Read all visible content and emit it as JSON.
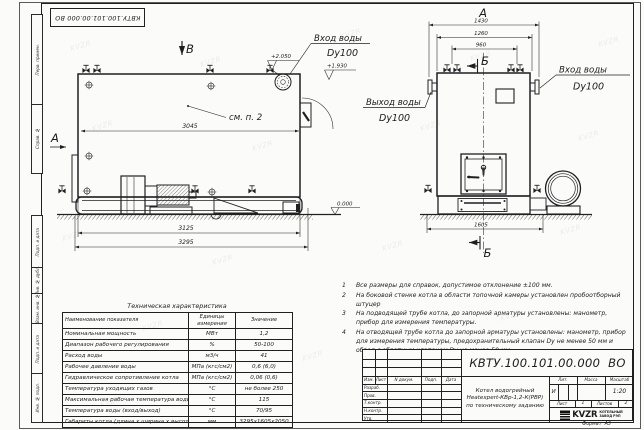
{
  "stamp_top": "КВТУ.100.101.00.000 ВО",
  "watermark": "KVZR",
  "frame_labels": {
    "top": [
      "Перв. примен.",
      "Справ. №"
    ],
    "bottom": [
      "Подп. и дата",
      "Инв. № дубл.",
      "Взам. инв. №",
      "Подп. и дата",
      "Инв. № подл."
    ]
  },
  "side_view": {
    "section_mark_top": "В",
    "view_arrow_left": "А",
    "note_ref": "см. п. 2",
    "dim_body": "3045",
    "dim_frame": "3125",
    "dim_overall": "3295",
    "level_inlet": "+2.050",
    "level_hatch": "+1.930",
    "inlet_line1": "Вход воды",
    "inlet_line2": "Dy100"
  },
  "front_view": {
    "view_label": "А",
    "section_label_top": "Б",
    "section_label_bottom": "Б",
    "dim_overall": "1430",
    "dim_flanges": "1260",
    "dim_valves": "960",
    "dim_base": "1605",
    "outlet_line1": "Выход воды",
    "outlet_line2": "Dy100",
    "inlet_line1": "Вход воды",
    "inlet_line2": "Dy100"
  },
  "ground_level": "0.000",
  "notes": [
    {
      "num": "1",
      "text": "Все размеры для справок, допустимое отклонение ±100 мм."
    },
    {
      "num": "2",
      "text": "На боковой стенке котла в области топочной камеры установлен пробоотборный штуцер"
    },
    {
      "num": "3",
      "text": "На подводящей трубе котла, до запорной арматуры установлены: манометр, прибор для измерения температуры."
    },
    {
      "num": "4",
      "text": "На отводящей трубе котла до запорной арматуры установлены: манометр, прибор для измерения температуры, предохранительный клапан Dy не менее 50 мм и обвод с обратным клапаном Dy не менее 50 мм."
    }
  ],
  "tech_table": {
    "title": "Техническая характеристика",
    "col_name": "Наименование показателя",
    "col_units": "Единицы измерения",
    "col_value": "Значение",
    "rows": [
      {
        "name": "Номинальная мощность",
        "units": "МВт",
        "value": "1,2"
      },
      {
        "name": "Диапазон рабочего регулирования",
        "units": "%",
        "value": "50-100"
      },
      {
        "name": "Расход воды",
        "units": "м3/ч",
        "value": "41"
      },
      {
        "name": "Рабочее давление воды",
        "units": "МПа (кгс/см2)",
        "value": "0,6 (6,0)"
      },
      {
        "name": "Гидравлическое сопротивление котла",
        "units": "МПа (кгс/см2)",
        "value": "0,06 (0,6)"
      },
      {
        "name": "Температура уходящих газов",
        "units": "°С",
        "value": "не более 250"
      },
      {
        "name": "Максимальная рабочая температура воды",
        "units": "°С",
        "value": "115"
      },
      {
        "name": "Температура воды (вход/выход)",
        "units": "°С",
        "value": "70/95"
      },
      {
        "name": "Габариты котла (длина х ширина х высота)",
        "units": "мм",
        "value": "3295х1605х2050"
      }
    ]
  },
  "title_block": {
    "doc_number": "КВТУ.100.101.00.000  ВО",
    "header": {
      "izm": "Изм.",
      "list": "Лист",
      "ndoc": "N докум.",
      "podp": "Подп.",
      "data": "Дата"
    },
    "sign_rows": [
      "Разраб.",
      "Пров.",
      "Т.контр.",
      "Н.контр.",
      "Утв."
    ],
    "title_line1": "Котел водогрейный",
    "title_line2": "Heatexpert-КВр-1,2-К(РВР)",
    "title_line3": "по техническому заданию",
    "lit_header": "Лит.",
    "mass_header": "Масса",
    "scale_header": "Масштаб",
    "lit_value": "И",
    "scale_value": "1:20",
    "sheet_label": "Лист",
    "sheet_value": "1",
    "sheets_label": "Листов",
    "sheets_value": "2",
    "brand": "KVZR",
    "brand_caption1": "КОТЕЛЬНЫЙ",
    "brand_caption2": "ЗАВОД РЭП",
    "format_label": "Формат  А3"
  }
}
